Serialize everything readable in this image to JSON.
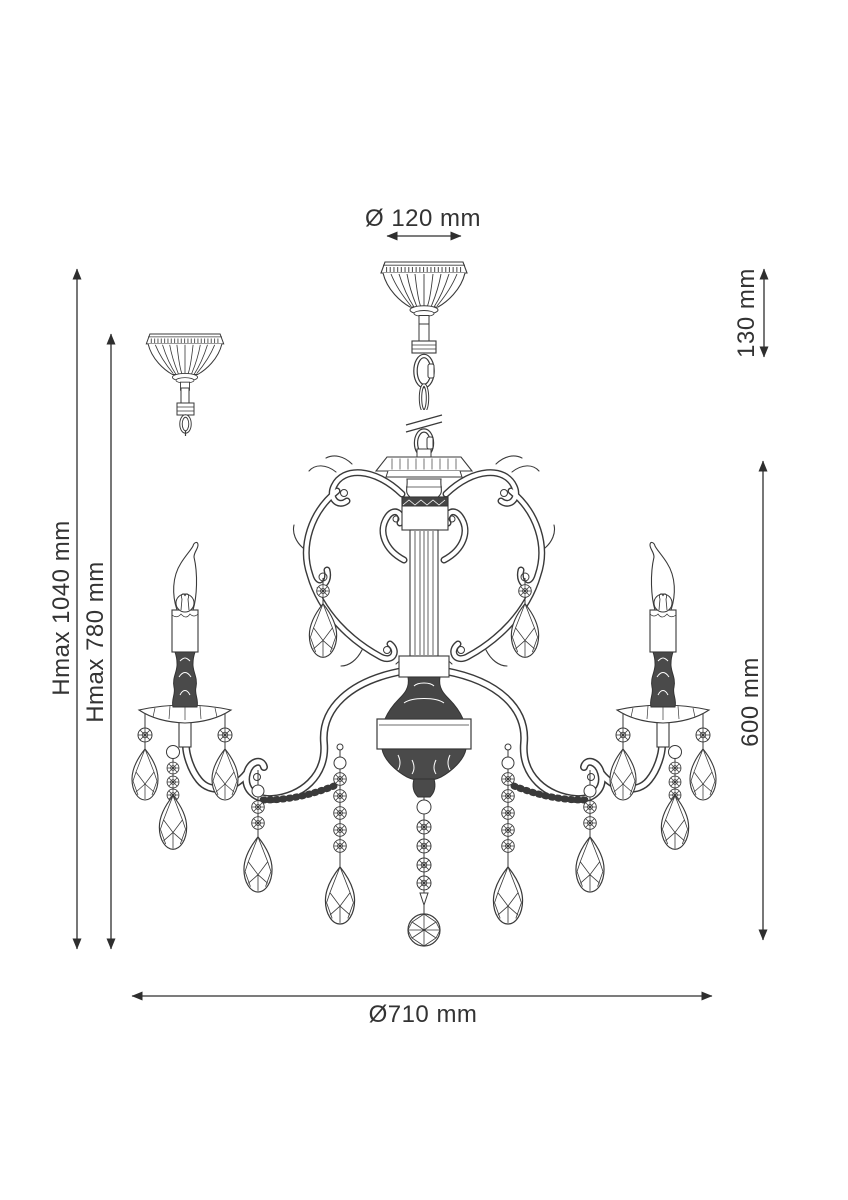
{
  "colors": {
    "background": "#ffffff",
    "ink": "#3a3a3a",
    "dimension_ink": "#2e2e2e",
    "dark_fill": "#4a4a4a"
  },
  "dimensions": {
    "canopy_diameter": "Ø 120 mm",
    "ceiling_offset_height": "130 mm",
    "max_height_full": "Hmax 1040 mm",
    "max_height_reduced": "Hmax 780 mm",
    "fixture_height": "600 mm",
    "fixture_diameter": "Ø710 mm"
  }
}
